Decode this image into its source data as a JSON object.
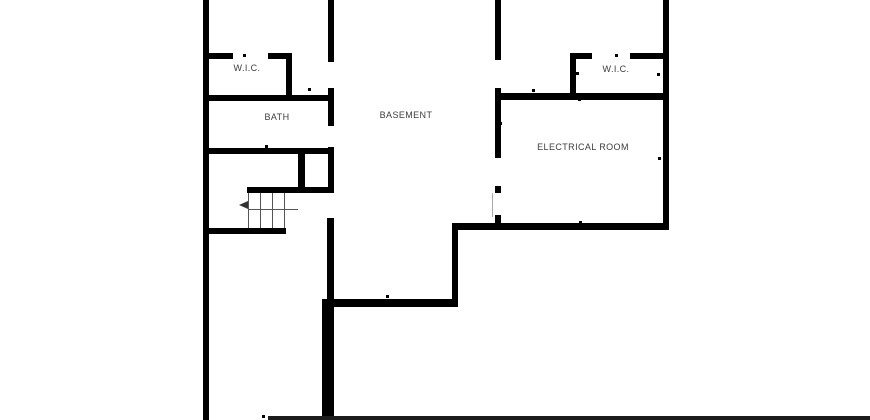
{
  "canvas": {
    "width": 870,
    "height": 420,
    "background": "#ffffff",
    "wall_color": "#000000",
    "label_color": "#3d3d3d",
    "thin_line_color": "#555555"
  },
  "rooms": [
    {
      "id": "wic-left",
      "label": "W.I.C.",
      "cx": 247,
      "cy": 68
    },
    {
      "id": "bath",
      "label": "BATH",
      "cx": 277,
      "cy": 117
    },
    {
      "id": "basement",
      "label": "BASEMENT",
      "cx": 406,
      "cy": 115
    },
    {
      "id": "wic-right",
      "label": "W.I.C.",
      "cx": 616,
      "cy": 69
    },
    {
      "id": "electrical-room",
      "label": "ELECTRICAL ROOM",
      "cx": 583,
      "cy": 147
    }
  ],
  "walls": [
    {
      "x": 203,
      "y": 0,
      "w": 6,
      "h": 420
    },
    {
      "x": 328,
      "y": 0,
      "w": 6,
      "h": 62
    },
    {
      "x": 495,
      "y": 0,
      "w": 6,
      "h": 60
    },
    {
      "x": 663,
      "y": 0,
      "w": 6,
      "h": 230
    },
    {
      "x": 203,
      "y": 53,
      "w": 30,
      "h": 6
    },
    {
      "x": 268,
      "y": 53,
      "w": 24,
      "h": 6
    },
    {
      "x": 286,
      "y": 53,
      "w": 6,
      "h": 48
    },
    {
      "x": 203,
      "y": 95,
      "w": 131,
      "h": 6
    },
    {
      "x": 328,
      "y": 88,
      "w": 6,
      "h": 38
    },
    {
      "x": 570,
      "y": 53,
      "w": 22,
      "h": 6
    },
    {
      "x": 630,
      "y": 53,
      "w": 38,
      "h": 6
    },
    {
      "x": 570,
      "y": 53,
      "w": 6,
      "h": 44
    },
    {
      "x": 495,
      "y": 93,
      "w": 173,
      "h": 7
    },
    {
      "x": 495,
      "y": 88,
      "w": 6,
      "h": 70
    },
    {
      "x": 203,
      "y": 148,
      "w": 131,
      "h": 6
    },
    {
      "x": 328,
      "y": 147,
      "w": 6,
      "h": 46
    },
    {
      "x": 298,
      "y": 152,
      "w": 7,
      "h": 41
    },
    {
      "x": 247,
      "y": 187,
      "w": 87,
      "h": 6
    },
    {
      "x": 203,
      "y": 228,
      "w": 83,
      "h": 6
    },
    {
      "x": 327,
      "y": 218,
      "w": 7,
      "h": 82
    },
    {
      "x": 322,
      "y": 299,
      "w": 12,
      "h": 121
    },
    {
      "x": 322,
      "y": 299,
      "w": 136,
      "h": 8
    },
    {
      "x": 452,
      "y": 223,
      "w": 6,
      "h": 84
    },
    {
      "x": 452,
      "y": 223,
      "w": 216,
      "h": 7
    },
    {
      "x": 495,
      "y": 186,
      "w": 6,
      "h": 7
    },
    {
      "x": 495,
      "y": 215,
      "w": 6,
      "h": 15
    },
    {
      "x": 268,
      "y": 416,
      "w": 602,
      "h": 4,
      "c": "#1c1c1c"
    }
  ],
  "ticks": [
    {
      "x": 244,
      "y": 55
    },
    {
      "x": 205,
      "y": 74
    },
    {
      "x": 205,
      "y": 110
    },
    {
      "x": 266,
      "y": 96
    },
    {
      "x": 309,
      "y": 89
    },
    {
      "x": 266,
      "y": 146
    },
    {
      "x": 205,
      "y": 205
    },
    {
      "x": 387,
      "y": 296
    },
    {
      "x": 616,
      "y": 55
    },
    {
      "x": 577,
      "y": 73
    },
    {
      "x": 658,
      "y": 74
    },
    {
      "x": 533,
      "y": 90
    },
    {
      "x": 579,
      "y": 99
    },
    {
      "x": 500,
      "y": 123
    },
    {
      "x": 659,
      "y": 158
    },
    {
      "x": 580,
      "y": 222
    },
    {
      "x": 263,
      "y": 416
    }
  ],
  "stairs": {
    "tread_x": [
      248,
      260,
      272,
      284
    ],
    "tread_top": 193,
    "tread_bottom": 228,
    "run_line": {
      "x1": 248,
      "x2": 298,
      "y": 209
    },
    "arrow": {
      "x": 239,
      "y": 205,
      "direction": "left"
    }
  },
  "door_leaf": {
    "x": 492,
    "y": 193,
    "h": 24
  }
}
